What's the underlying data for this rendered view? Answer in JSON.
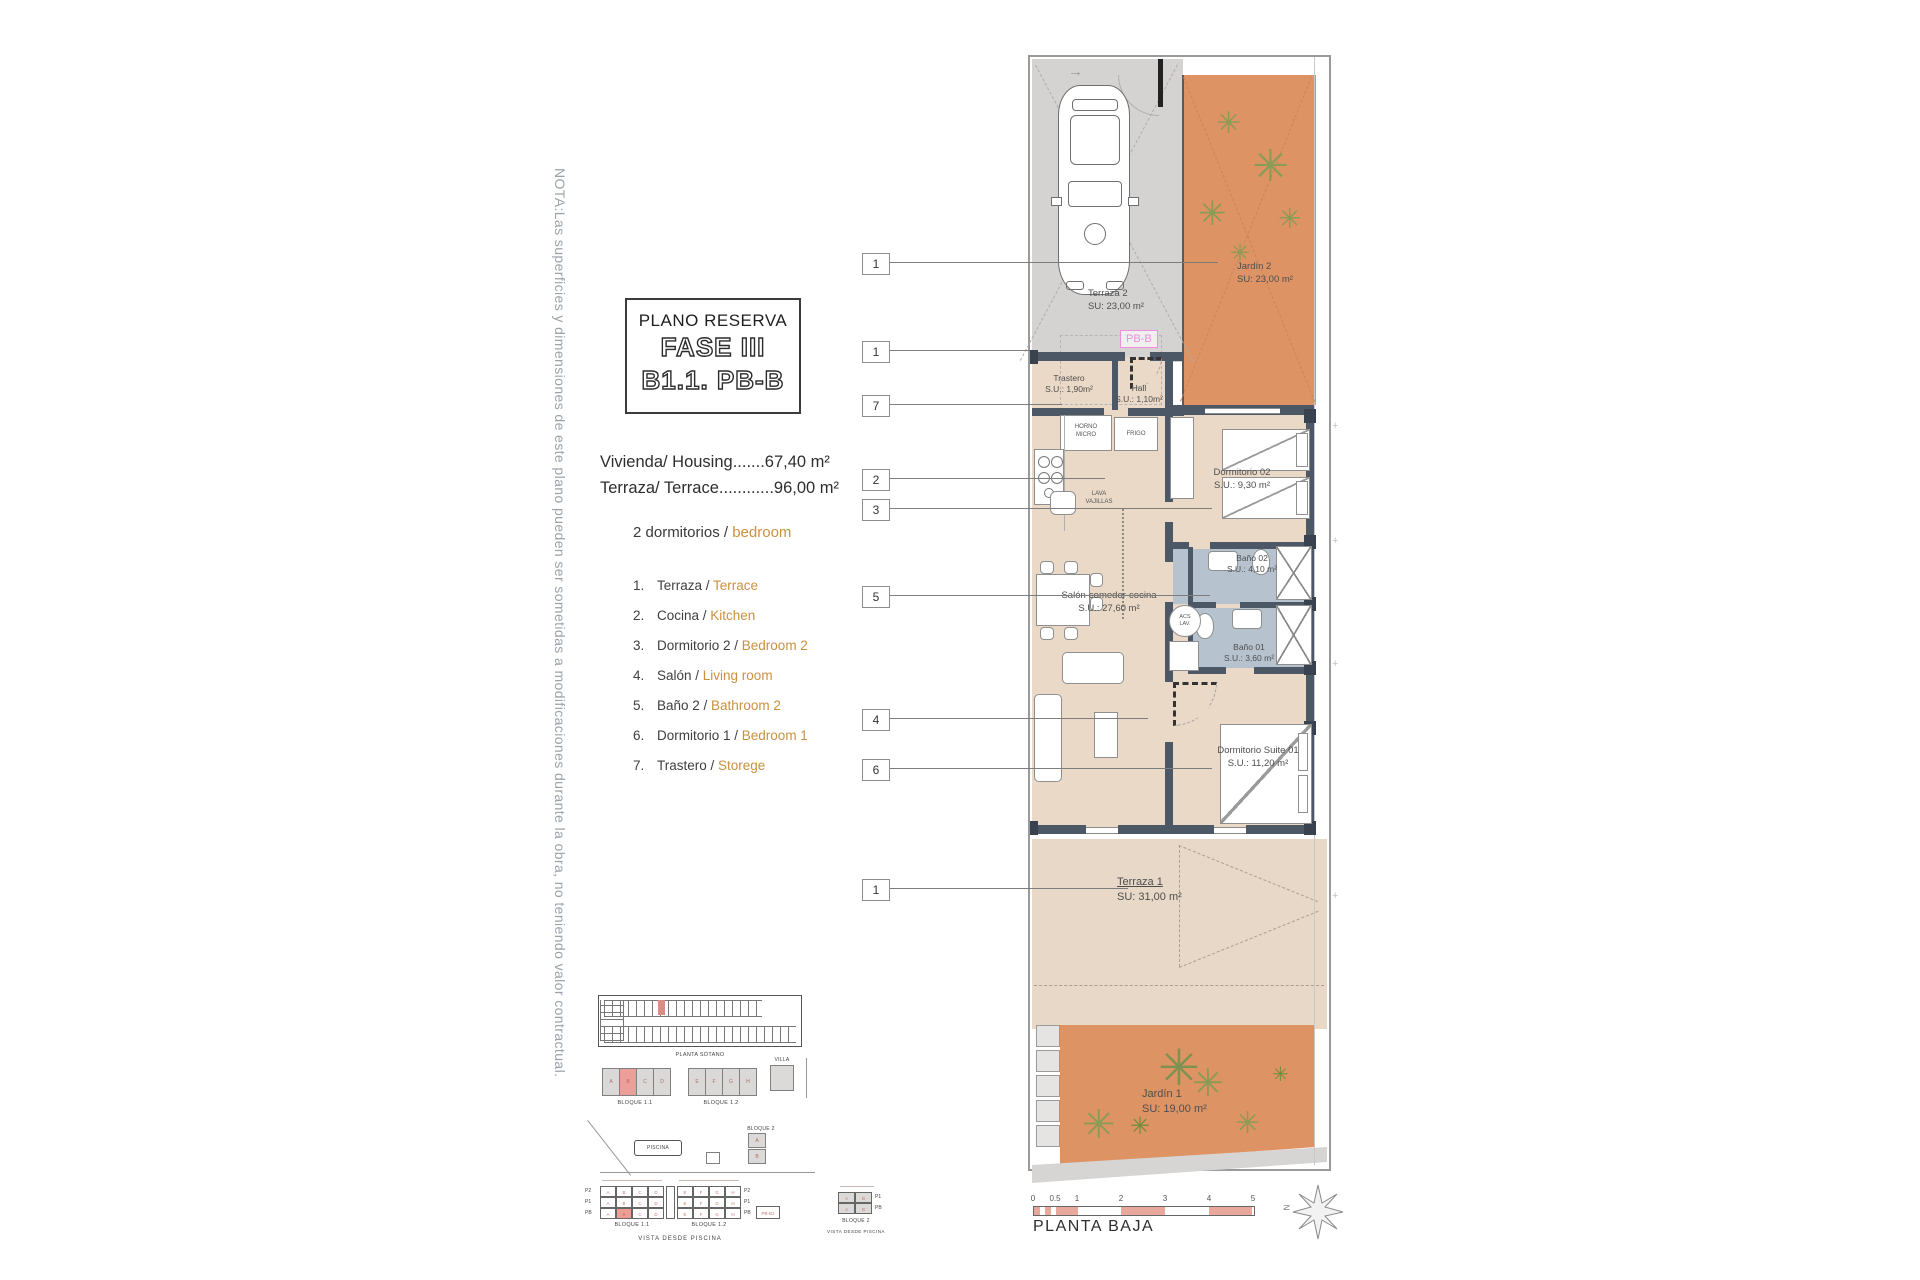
{
  "note": "NOTA:Las superficies y dimensiones de este plano pueden ser sometidas a modificaciones durante la obra, no teniendo valor contractual.",
  "title_block": {
    "subtitle": "PLANO RESERVA",
    "phase": "FASE III",
    "unit": "B1.1. PB-B"
  },
  "areas": {
    "housing": "Vivienda/ Housing.......67,40 m²",
    "terrace": "Terraza/ Terrace............96,00 m²"
  },
  "bedrooms": {
    "es": "2 dormitorios / ",
    "en": "bedroom"
  },
  "legend": [
    {
      "n": "1.",
      "es": "Terraza / ",
      "en": "Terrace"
    },
    {
      "n": "2.",
      "es": "Cocina / ",
      "en": "Kitchen"
    },
    {
      "n": "3.",
      "es": "Dormitorio 2 / ",
      "en": "Bedroom 2"
    },
    {
      "n": "4.",
      "es": "Salón / ",
      "en": "Living room"
    },
    {
      "n": "5.",
      "es": "Baño 2 / ",
      "en": "Bathroom 2"
    },
    {
      "n": "6.",
      "es": "Dormitorio 1 / ",
      "en": "Bedroom 1"
    },
    {
      "n": "7.",
      "es": "Trastero / ",
      "en": "Storege"
    }
  ],
  "plan": {
    "tag": "PB-B",
    "callouts": [
      "1",
      "1",
      "7",
      "2",
      "3",
      "5",
      "4",
      "6",
      "1"
    ],
    "rooms": {
      "terraza2": {
        "name": "Terraza 2",
        "area": "SU: 23,00 m²"
      },
      "jardin2": {
        "name": "Jardín 2",
        "area": "SU: 23,00 m²"
      },
      "trastero": {
        "name": "Trastero",
        "area": "S.U.: 1,90m²"
      },
      "hall": {
        "name": "Hall",
        "area": "S.U.: 1,10m²"
      },
      "dormitorio02": {
        "name": "Dormitorio 02",
        "area": "S.U.: 9,30 m²"
      },
      "bano02": {
        "name": "Baño 02",
        "area": "S.U.: 4,10 m²"
      },
      "bano01": {
        "name": "Baño 01",
        "area": "S.U.: 3,60 m²"
      },
      "salon": {
        "name": "Salón-comedor-cocina",
        "area": "S.U.: 27,60 m²"
      },
      "suite": {
        "name": "Dormitorio Suite 01",
        "area": "S.U.: 11,20 m²"
      },
      "terraza1": {
        "name": "Terraza 1",
        "area": "SU: 31,00 m²"
      },
      "jardin1": {
        "name": "Jardín 1",
        "area": "SU: 19,00 m²"
      }
    },
    "kitchen": {
      "horno1": "HORNO",
      "horno2": "MICRO",
      "frigo": "FRIGO",
      "lava1": "LAVA",
      "lava2": "VAJILLAS",
      "acs1": "ACS",
      "acs2": "LAV."
    }
  },
  "site": {
    "planta_sotano": "PLANTA SÓTANO",
    "bloque11": "BLOQUE 1.1",
    "bloque12": "BLOQUE 1.2",
    "bloque2": "BLOQUE 2",
    "villa": "VILLA",
    "piscina": "PISCINA",
    "vista": "VISTA DESDE PISCINA",
    "floors": [
      "P2",
      "P1",
      "PB"
    ],
    "units_b11": [
      "A",
      "B",
      "C",
      "D"
    ],
    "units_b12": [
      "E",
      "F",
      "G",
      "H"
    ],
    "units_b2": [
      "A",
      "B"
    ],
    "annex": "PB-B1"
  },
  "scale_bar": {
    "ticks": [
      "0",
      "0.5",
      "1",
      "2",
      "3",
      "4",
      "5"
    ],
    "label": "PLANTA BAJA",
    "north": "N"
  }
}
